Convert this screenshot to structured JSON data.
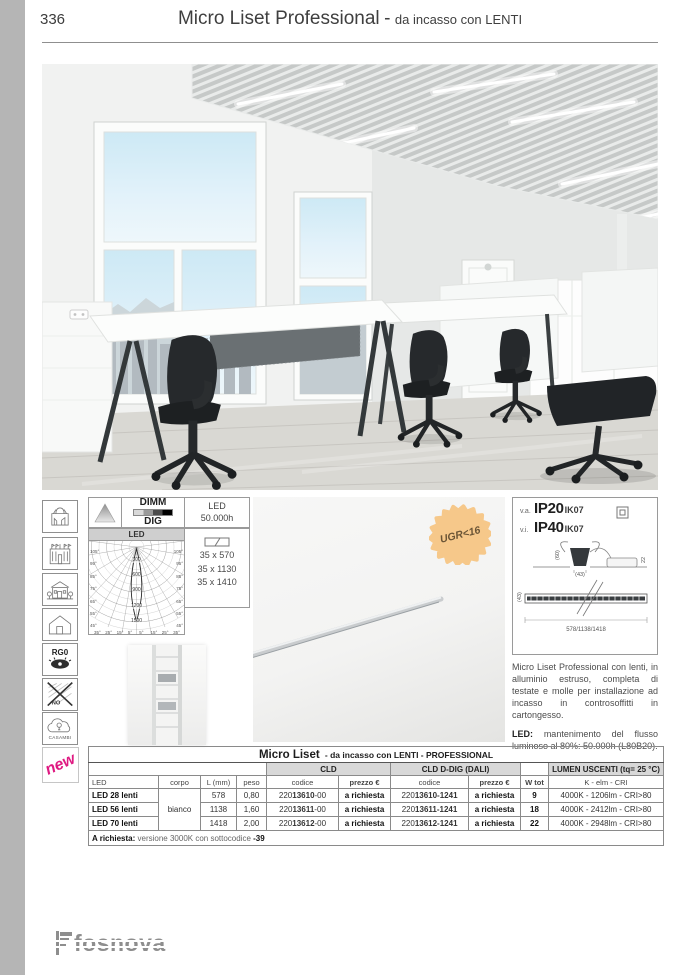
{
  "page": {
    "number": "336",
    "title": "Micro Liset Professional",
    "title_sep": "-",
    "subtitle": "da incasso con LENTI"
  },
  "badges": {
    "ugr": "UGR<16",
    "new": "new",
    "rg0": "RG0",
    "no": "NO",
    "casambi": "CASAMBI"
  },
  "features": {
    "dimm": "DIMM",
    "dig": "DIG",
    "led_life_1": "LED",
    "led_life_2": "50.000h",
    "sizes": [
      "35 x 570",
      "35 x 1130",
      "35 x 1410"
    ],
    "polar": {
      "title": "LED",
      "rings": [
        "300",
        "600",
        "900",
        "1200",
        "1500"
      ],
      "angles_left": [
        "105°",
        "95°",
        "85°",
        "75°",
        "65°",
        "55°",
        "45°"
      ],
      "angles_right": [
        "105°",
        "95°",
        "85°",
        "75°",
        "65°",
        "55°",
        "45°"
      ],
      "angles_bottom": [
        "35°",
        "25°",
        "15°",
        "5°",
        "5°",
        "15°",
        "25°",
        "35°"
      ]
    }
  },
  "ratings": {
    "row1_label": "v.a.",
    "row1_ip": "IP20",
    "row1_ik": "IK07",
    "row2_label": "v.i.",
    "row2_ip": "IP40",
    "row2_ik": "IK07",
    "dim_height": "(60)",
    "dim_width": "(43)",
    "dim_driver": "22",
    "dim_bar_h": "(43)",
    "dim_lengths": "578/1138/1418"
  },
  "description": {
    "p1": "Micro Liset Professional con lenti, in alluminio estruso, completa di testate e molle per installazione ad incasso in controsoffitti in cartongesso.",
    "p2_label": "LED:",
    "p2_text": " mantenimento del flusso luminoso al 80%: 50.000h (L80B20)."
  },
  "table": {
    "title": "Micro Liset",
    "title_suffix": "- da incasso con LENTI - PROFESSIONAL",
    "groups": {
      "cld": "CLD",
      "dali": "CLD D-DIG (DALI)",
      "lumen": "LUMEN USCENTI (tq= 25 °C)"
    },
    "columns": {
      "led": "LED",
      "corpo": "corpo",
      "l": "L (mm)",
      "peso": "peso",
      "codice": "codice",
      "prezzo": "prezzo €",
      "w": "W tot",
      "lumen": "K - elm - CRI"
    },
    "corpo": "bianco",
    "rows": [
      {
        "led": "LED 28 lenti",
        "l": "578",
        "peso": "0,80",
        "cld_pre": "220",
        "cld_bold": "13610",
        "cld_suf": "-00",
        "cld_price": "a richiesta",
        "dali_pre": "220",
        "dali_bold": "13610-1241",
        "dali_price": "a richiesta",
        "w": "9",
        "lumen": "4000K - 1206lm - CRI>80"
      },
      {
        "led": "LED 56 lenti",
        "l": "1138",
        "peso": "1,60",
        "cld_pre": "220",
        "cld_bold": "13611",
        "cld_suf": "-00",
        "cld_price": "a richiesta",
        "dali_pre": "220",
        "dali_bold": "13611-1241",
        "dali_price": "a richiesta",
        "w": "18",
        "lumen": "4000K - 2412lm - CRI>80"
      },
      {
        "led": "LED 70 lenti",
        "l": "1418",
        "peso": "2,00",
        "cld_pre": "220",
        "cld_bold": "13612",
        "cld_suf": "-00",
        "cld_price": "a richiesta",
        "dali_pre": "220",
        "dali_bold": "13612-1241",
        "dali_price": "a richiesta",
        "w": "22",
        "lumen": "4000K - 2948lm - CRI>80"
      }
    ],
    "note_label": "A richiesta:",
    "note_text": " versione 3000K con sottocodice ",
    "note_bold": "-39"
  },
  "footer": {
    "brand": "fosnova"
  },
  "colors": {
    "accent_new": "#df1a82",
    "ugr_badge": "#f6c88a",
    "band_gray": "#b5b5b5",
    "table_head_gray": "#d8d8d8"
  }
}
